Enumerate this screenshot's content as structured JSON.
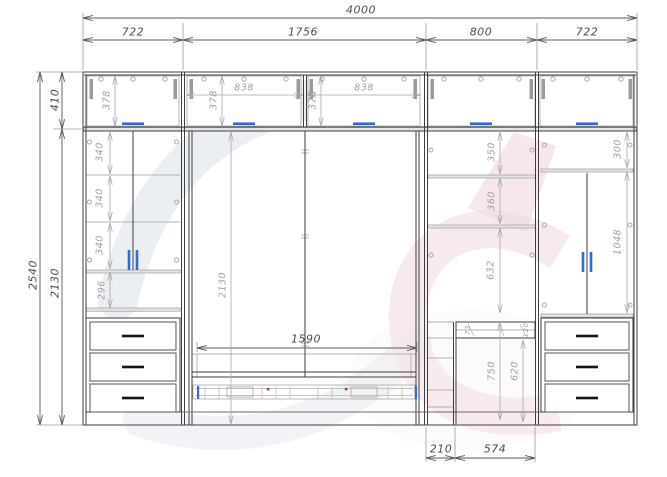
{
  "drawing": {
    "overall_width": "4000",
    "overall_height": "2540",
    "section_widths": [
      "722",
      "1756",
      "800",
      "722"
    ]
  },
  "colors": {
    "line_dark": "#3e3e3e",
    "line_light": "#b0b0b0",
    "dim_dark": "#5a5a5a",
    "dim_light": "#a9a9a9",
    "handle_blue": "#2f6bdb",
    "handle_black": "#151515",
    "accent_red": "#cc3333",
    "watermark_blue": "#b6c3d6",
    "watermark_pink": "#e2bac4"
  },
  "dimension_labels": [
    {
      "name": "width-total",
      "text": "4000",
      "x": 361,
      "y": 10,
      "rot": 0,
      "tone": "dark"
    },
    {
      "name": "top-col-1",
      "text": "722",
      "x": 133,
      "y": 32,
      "rot": 0,
      "tone": "dark"
    },
    {
      "name": "top-col-2",
      "text": "1756",
      "x": 303,
      "y": 32,
      "rot": 0,
      "tone": "dark"
    },
    {
      "name": "top-col-3",
      "text": "800",
      "x": 481,
      "y": 32,
      "rot": 0,
      "tone": "dark"
    },
    {
      "name": "top-col-4",
      "text": "722",
      "x": 587,
      "y": 32,
      "rot": 0,
      "tone": "dark"
    },
    {
      "name": "height-total",
      "text": "2540",
      "x": 33,
      "y": 275,
      "rot": -90,
      "tone": "dark"
    },
    {
      "name": "height-top-row",
      "text": "410",
      "x": 55,
      "y": 100,
      "rot": -90,
      "tone": "dark"
    },
    {
      "name": "height-left-main",
      "text": "2130",
      "x": 55,
      "y": 283,
      "rot": -90,
      "tone": "dark"
    },
    {
      "name": "bed-width",
      "text": "1590",
      "x": 306,
      "y": 339,
      "rot": 0,
      "tone": "dark"
    },
    {
      "name": "niche-offset",
      "text": "210",
      "x": 441,
      "y": 449,
      "rot": 0,
      "tone": "dark"
    },
    {
      "name": "niche-width",
      "text": "574",
      "x": 495,
      "y": 449,
      "rot": 0,
      "tone": "dark"
    },
    {
      "name": "flap-height-left",
      "text": "378",
      "x": 107,
      "y": 100,
      "rot": -90,
      "tone": "light"
    },
    {
      "name": "flap-height-mid-1",
      "text": "378",
      "x": 214,
      "y": 100,
      "rot": -90,
      "tone": "light"
    },
    {
      "name": "flap-height-mid-2",
      "text": "378",
      "x": 313,
      "y": 100,
      "rot": -90,
      "tone": "light"
    },
    {
      "name": "flap-width-1",
      "text": "838",
      "x": 244,
      "y": 88,
      "rot": 0,
      "tone": "light"
    },
    {
      "name": "flap-width-2",
      "text": "838",
      "x": 364,
      "y": 88,
      "rot": 0,
      "tone": "light"
    },
    {
      "name": "left-shelf-1",
      "text": "340",
      "x": 100,
      "y": 152,
      "rot": -90,
      "tone": "light"
    },
    {
      "name": "left-shelf-2",
      "text": "340",
      "x": 100,
      "y": 198,
      "rot": -90,
      "tone": "light"
    },
    {
      "name": "left-shelf-3",
      "text": "340",
      "x": 100,
      "y": 245,
      "rot": -90,
      "tone": "light"
    },
    {
      "name": "left-open-shelf",
      "text": "296",
      "x": 102,
      "y": 290,
      "rot": -90,
      "tone": "light"
    },
    {
      "name": "mid-inner-height",
      "text": "2130",
      "x": 223,
      "y": 285,
      "rot": -90,
      "tone": "light"
    },
    {
      "name": "right-mid-shelf-1",
      "text": "350",
      "x": 492,
      "y": 152,
      "rot": -90,
      "tone": "light"
    },
    {
      "name": "right-mid-shelf-2",
      "text": "360",
      "x": 492,
      "y": 201,
      "rot": -90,
      "tone": "light"
    },
    {
      "name": "right-mid-opening",
      "text": "632",
      "x": 491,
      "y": 270,
      "rot": -90,
      "tone": "light"
    },
    {
      "name": "niche-height-1",
      "text": "750",
      "x": 492,
      "y": 371,
      "rot": -90,
      "tone": "light"
    },
    {
      "name": "niche-height-2",
      "text": "620",
      "x": 515,
      "y": 371,
      "rot": -90,
      "tone": "light"
    },
    {
      "name": "right-top-shelf",
      "text": "300",
      "x": 618,
      "y": 149,
      "rot": -90,
      "tone": "light"
    },
    {
      "name": "right-door-height",
      "text": "1048",
      "x": 618,
      "y": 242,
      "rot": -90,
      "tone": "light"
    },
    {
      "name": "niche-top-dim-1",
      "text": "73",
      "x": 468,
      "y": 330,
      "rot": -90,
      "tone": "tiny"
    },
    {
      "name": "niche-top-dim-2",
      "text": "120",
      "x": 526,
      "y": 330,
      "rot": -90,
      "tone": "tiny"
    }
  ]
}
